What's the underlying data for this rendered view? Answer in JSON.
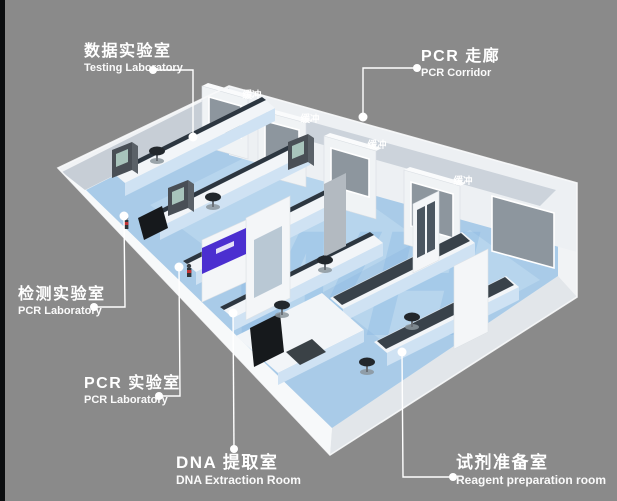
{
  "labels": {
    "testing_lab": {
      "zh": "数据实验室",
      "en": "Testing Laboratory"
    },
    "pcr_corridor": {
      "zh": "PCR 走廊",
      "en": "PCR Corridor"
    },
    "detection_lab": {
      "zh": "检测实验室",
      "en": "PCR Laboratory"
    },
    "pcr_lab": {
      "zh": "PCR 实验室",
      "en": "PCR Laboratory"
    },
    "dna_room": {
      "zh": "DNA 提取室",
      "en": "DNA Extraction Room"
    },
    "reagent_room": {
      "zh": "试剂准备室",
      "en": "Reagent preparation room"
    }
  },
  "buffer_labels": [
    "缓冲",
    "缓冲",
    "缓冲",
    "缓冲"
  ],
  "watermark": "WH",
  "colors": {
    "bg": "#8a8a8a",
    "edge_strip": "#0c0e10",
    "wall_white": "#f1f3f5",
    "floor_blue": "#a9cbe8",
    "corridor": "#ccd3db",
    "window_glass": "#8d969e",
    "bench_front": "#cfe2f3",
    "bench_top_dark": "#39424a",
    "purple": "#4b2fd0",
    "watermark": "#7fb2e2",
    "label": "#ffffff"
  }
}
